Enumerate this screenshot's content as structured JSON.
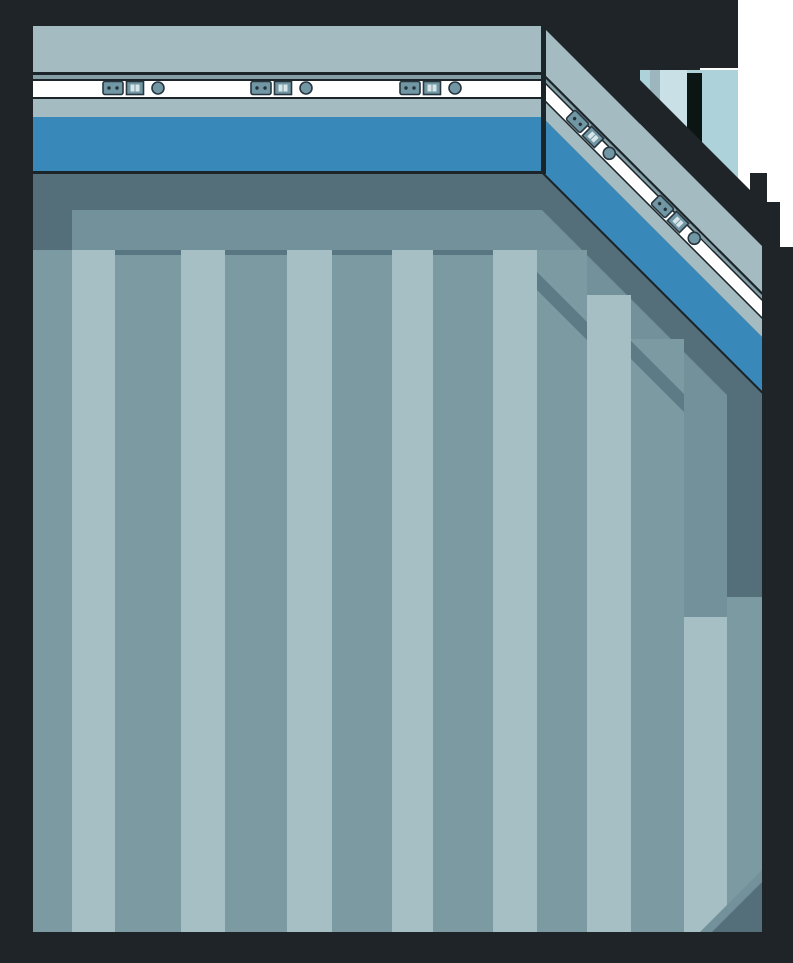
{
  "scene": {
    "type": "game-room-interior",
    "outlet_groups_on_top_wall": 3,
    "outlet_groups_on_diagonal_wall": 2,
    "floor_stripe_count": 15
  },
  "colors": {
    "frame": "#1e2427",
    "outside": "#ffffff",
    "wall_gray": "#a3bbc1",
    "wall_gray_strip": "#849ea6",
    "wall_line": "#1b2428",
    "wall_white": "#ffffff",
    "wall_blue": "#3889b9",
    "outlet_fill": "#7297a4",
    "outlet_stroke": "#283640",
    "outlet_dot": "#243139",
    "outlet_slot": "#d7e5e9",
    "floor_shadow": "#546f7a",
    "floor_mid": "#73919a",
    "stripe_mid": "#7b9aa2",
    "stripe_light": "#a6bfc5",
    "stripe_edge": "#597782",
    "step_accent": "#5d7b86",
    "pale_wall": "#aed2da",
    "pale_wall_light": "#c8e0e6",
    "pale_wall_gray": "#9db6bd",
    "doorway": "#0b1514"
  }
}
